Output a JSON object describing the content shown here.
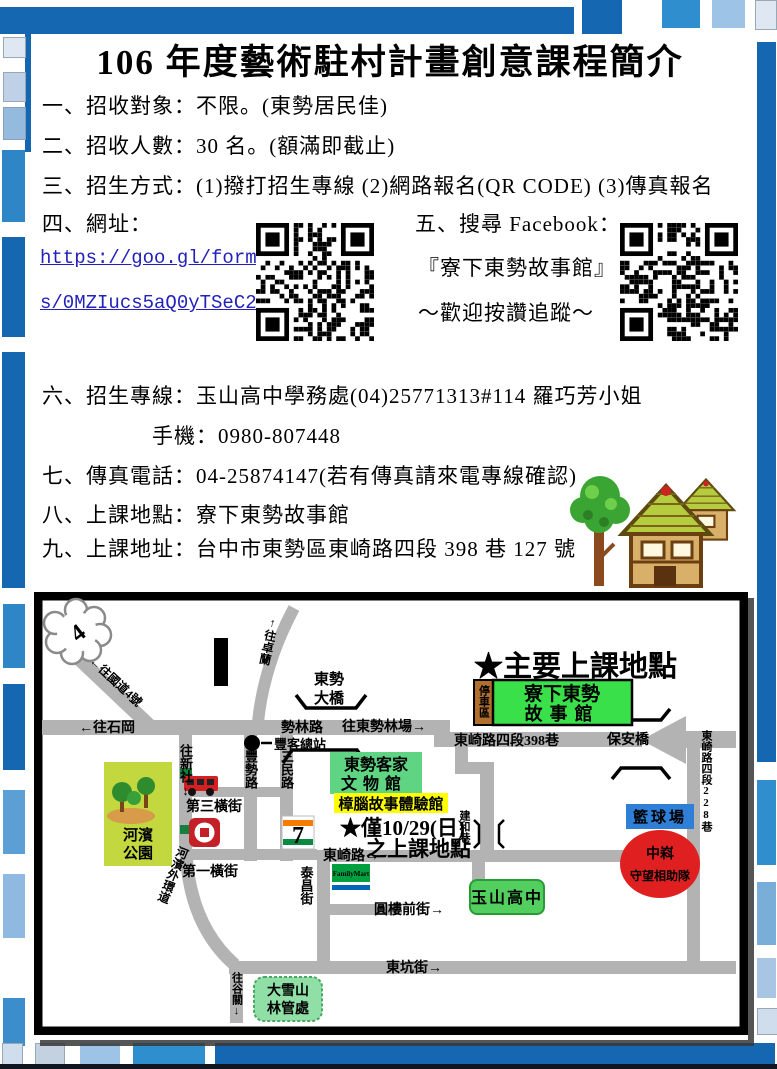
{
  "header": {
    "title": "106 年度藝術駐村計畫創意課程簡介"
  },
  "intro": {
    "line1": "一、招收對象：不限。(東勢居民佳)",
    "line2": "二、招收人數：30 名。(額滿即截止)",
    "line3": "三、招生方式：(1)撥打招生專線 (2)網路報名(QR CODE) (3)傳真報名"
  },
  "website": {
    "label": "四、網址：",
    "url_line1": "https://goo.gl/form",
    "url_line2": "s/0MZIucs5aQ0yTSeC2"
  },
  "facebook": {
    "label": "五、搜尋 Facebook：",
    "page_name": "『寮下東勢故事館』",
    "slogan": "～歡迎按讚追蹤～"
  },
  "contact": {
    "hotline": "六、招生專線：玉山高中學務處(04)25771313#114 羅巧芳小姐",
    "mobile": "手機：0980-807448",
    "fax": "七、傳真電話：04-25874147(若有傳真請來電專線確認)",
    "venue": "八、上課地點：寮下東勢故事館",
    "address": "九、上課地址：台中市東勢區東崎路四段 398 巷 127 號"
  },
  "map": {
    "labels": {
      "highway_shield": "4",
      "to_national_highway4": "←往國道4號",
      "to_shigang": "←往石岡",
      "dongshi_bridge_1": "東勢",
      "dongshi_bridge_2": "大橋",
      "to_zhuolan": "↑往卓蘭",
      "to_xinshe": "往新社↓",
      "shilin_road": "勢林路",
      "to_dongshi_forest": "往東勢林場→",
      "bus_terminal": "豐客總站",
      "fengshi_road": "豐勢路",
      "sanmin_road": "三民路",
      "third_cross_street": "第三橫街",
      "first_cross_street": "第一橫街",
      "riverside_park_1": "河濱",
      "riverside_park_2": "公園",
      "riverside_ring_road": "河濱外環道",
      "to_guguan": "往谷關↓",
      "daxueshan_1": "大雪山",
      "daxueshan_2": "林管處",
      "hakka_museum_1": "東勢客家",
      "hakka_museum_2": "文物館",
      "camphor_museum": "樟腦故事體驗館",
      "note_1": "★僅10/29(日)",
      "note_2": "之上課地點",
      "main_note": "★主要上課地點",
      "parking": "停車區",
      "story_house_1": "寮下東勢",
      "story_house_2": "故事館",
      "lane398": "東崎路四段398巷",
      "baoan_bridge": "保安橋",
      "lane228": "東崎路四段228巷",
      "basketball": "籃球場",
      "watch_1": "中嵙",
      "watch_2": "守望相助隊",
      "dongqi_road": "東崎路→",
      "taichang_street": "泰昌街",
      "jianhe_lane": "建和巷",
      "yuanlou_street": "圓樓前街→",
      "dongkeng_street": "東坑街→",
      "yushan_high": "玉山高中",
      "seven_eleven_7": "7",
      "familymart": "FamilyMart"
    }
  },
  "colors": {
    "accent_blue": "#1467b0",
    "bright_blue": "#2f8fce",
    "light_blue": "#9dc3e6",
    "link_blue": "#2222bb",
    "highlight_red": "#cc0000",
    "road_gray": "#b3b3b3",
    "story_house_green": "#3ae04a",
    "camphor_yellow": "#ffff00",
    "basketball_blue": "#2f7fd6",
    "watch_team_red": "#e02020",
    "park_green": "#c2d83e"
  }
}
